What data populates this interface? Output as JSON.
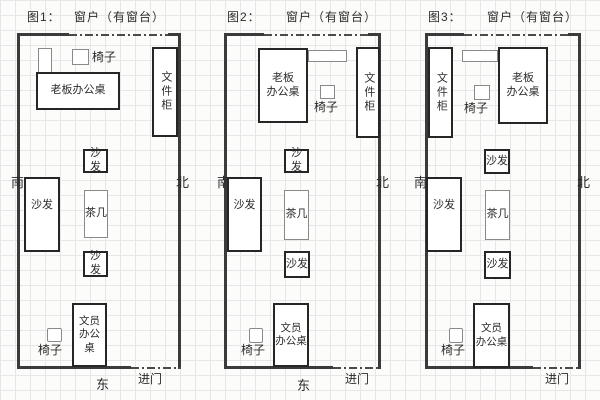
{
  "colors": {
    "wall": "#3b3b3b",
    "furniture_outline": "#262626",
    "grid_line": "#e5e7e8",
    "background": "#fcfcfa",
    "text": "#2b2b2b"
  },
  "figures": [
    {
      "label": "图1：",
      "window_label": "窗户（有窗台）",
      "boss_desk_line1": "老板办公桌",
      "chair_top": "椅子",
      "file_cabinet": "文件柜",
      "sofa_mid": "沙发",
      "sofa_left": "沙发",
      "tea_table": "茶几",
      "sofa_small": "沙发",
      "clerk_desk_line1": "文员",
      "clerk_desk_line2": "办公桌",
      "chair_bottom": "椅子",
      "south": "南",
      "north": "北",
      "east": "东",
      "entry": "进门"
    },
    {
      "label": "图2：",
      "window_label": "窗户（有窗台）",
      "boss_desk_line1": "老板",
      "boss_desk_line2": "办公桌",
      "chair_top": "椅子",
      "file_cabinet": "文件柜",
      "sofa_mid": "沙发",
      "sofa_left": "沙发",
      "tea_table": "茶几",
      "sofa_small": "沙发",
      "clerk_desk_line1": "文员",
      "clerk_desk_line2": "办公桌",
      "chair_bottom": "椅子",
      "south": "南",
      "north": "北",
      "east": "东",
      "entry": "进门"
    },
    {
      "label": "图3：",
      "window_label": "窗户（有窗台）",
      "boss_desk_line1": "老板",
      "boss_desk_line2": "办公桌",
      "chair_top": "椅子",
      "file_cabinet": "文件柜",
      "sofa_mid": "沙发",
      "sofa_left": "沙发",
      "tea_table": "茶几",
      "sofa_small": "沙发",
      "clerk_desk_line1": "文员",
      "clerk_desk_line2": "办公桌",
      "chair_bottom": "椅子",
      "south": "南",
      "north": "北",
      "entry": "进门"
    }
  ]
}
